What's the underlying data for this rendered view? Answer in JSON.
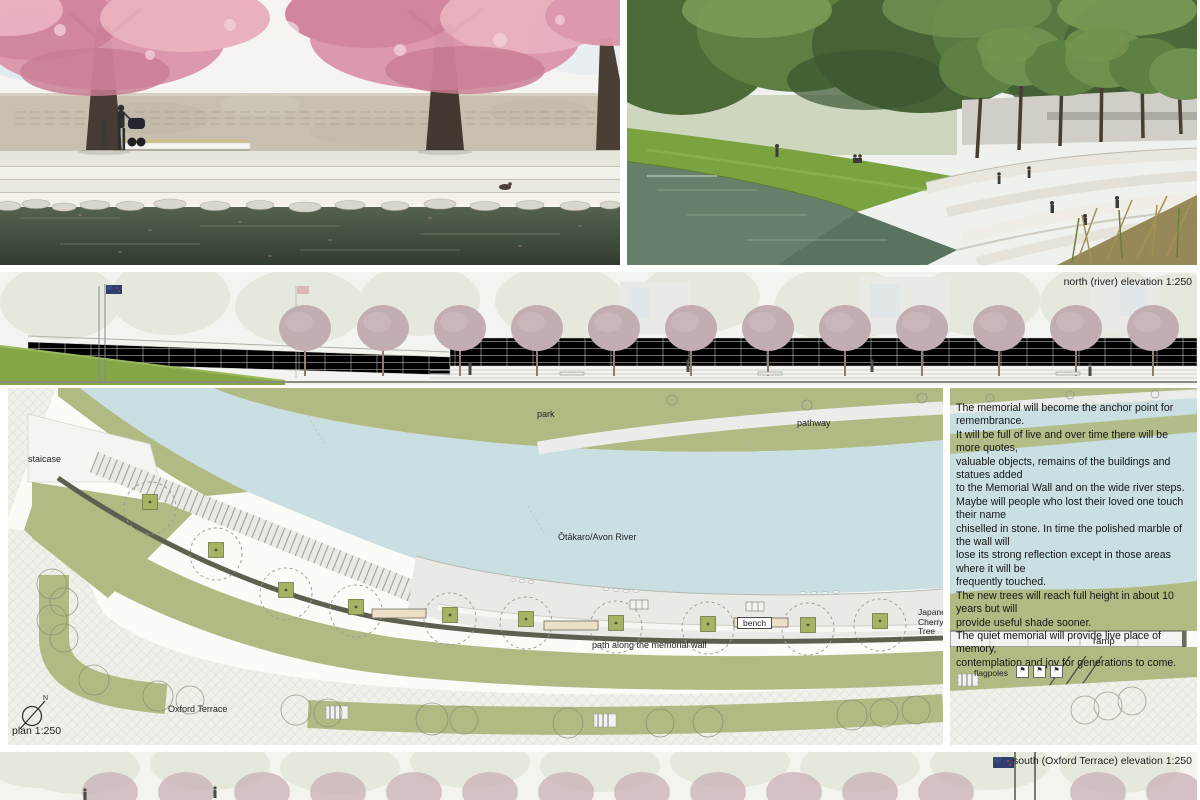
{
  "elevations": {
    "north_label": "north (river) elevation 1:250",
    "south_label": "south (Oxford Terrace) elevation 1:250"
  },
  "plan": {
    "scale_label": "plan 1:250",
    "north_arrow_letter": "N",
    "flag_glyph": "⚑",
    "labels": {
      "staircase": "staicase",
      "park": "park",
      "pathway": "pathway",
      "river": "Ōtākaro/Avon River",
      "bench": "bench",
      "cherry_tree": "Japanese\nCherry Tree",
      "path_wall": "path along the memorial wall",
      "ramp": "ramp",
      "flagpoles": "flagpoles",
      "oxford_terrace": "Oxford Terrace"
    }
  },
  "description": {
    "text": "The memorial will become the anchor point for remembrance.\nIt will be full of live and over time there will be more quotes,\nvaluable objects, remains of the buildings and statues added\nto the Memorial Wall and on the wide river steps.\nMaybe will people who lost their loved one touch their name\nchiselled in stone.  In time the polished marble of the wall will\nlose its strong reflection except in those areas where it will be\nfrequently touched.\nThe new trees will reach full height in about 10 years but will\nprovide useful shade sooner.\nThe quiet memorial will provide live place of memory,\ncontemplation and joy for generations to come."
  },
  "colors": {
    "park_green": "#b2ba84",
    "river_blue": "#c9dfe2",
    "path_gray": "#e9e9e6",
    "wall_dark": "#5e604f",
    "planter_green": "#a6b264",
    "bench_cream": "#ecdfc8",
    "grass_green": "#85a647",
    "blossom_pink": "#dc96aa",
    "water_dark": "#3a4636",
    "foliage_green": "#5d7f42",
    "faded_mauve": "#c2adb1"
  }
}
